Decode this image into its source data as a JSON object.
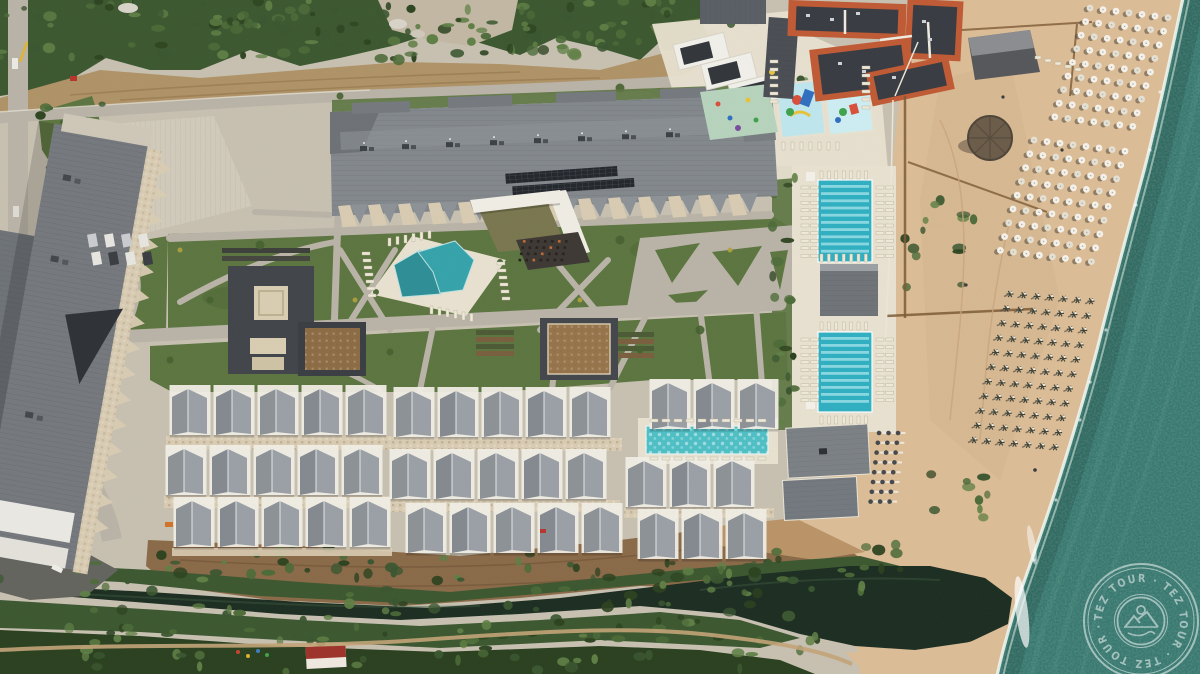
{
  "watermark": {
    "brand": "TEZ TOUR",
    "ring_text": "TEZ TOUR · TEZ TOUR · TEZ TOUR ·",
    "icon": "sun-over-mountains-logo"
  },
  "palette": {
    "ground": "#c8c1b2",
    "sand": "#dcbd97",
    "sandLight": "#e8cfa8",
    "sea": "#36786f",
    "seaDark": "#23524b",
    "surf": "#eef6f0",
    "lawn": "#5c7540",
    "lawnDark": "#47602f",
    "veg": "#3c5830",
    "vegDark": "#2a401f",
    "dirt": "#b09367",
    "dirtDark": "#8a6a48",
    "road": "#bab4a8",
    "roofGray": "#83888d",
    "roofLight": "#9aa0a5",
    "panelDark": "#23262b",
    "deck": "#e9e2d1",
    "terrace": "#d9ccb3",
    "terracotta": "#c05a34",
    "orangeRoofDark": "#383c42",
    "pool": "#2fb0c2",
    "poolLane": "#93dde5",
    "poolVilla": "#4fc0c6",
    "kidsPool": "#bfe7ee",
    "mint": "#b7d4bd",
    "river": "#1c2d21",
    "boardwalk": "#7d5a36",
    "white": "#f1eee6"
  },
  "decor": {
    "umbrella_grids": [
      {
        "x": 1090,
        "y": 8,
        "rows": 9,
        "cols": 7,
        "col_dx": 13,
        "col_dy": 1.6,
        "row_dx": -4.4,
        "row_dy": 13.6,
        "style": "open"
      },
      {
        "x": 1034,
        "y": 140,
        "rows": 9,
        "cols": 8,
        "col_dx": 13,
        "col_dy": 1.6,
        "row_dx": -4.2,
        "row_dy": 13.8,
        "style": "open"
      },
      {
        "x": 1010,
        "y": 294,
        "rows": 11,
        "cols": 7,
        "col_dx": 13.5,
        "col_dy": 1.2,
        "row_dx": -3.6,
        "row_dy": 14.6,
        "style": "closed"
      }
    ],
    "lap_pools": [
      {
        "x": 818,
        "y": 180,
        "w": 54,
        "h": 82,
        "lanes": 10
      },
      {
        "x": 818,
        "y": 332,
        "w": 54,
        "h": 80,
        "lanes": 10
      }
    ],
    "villa_rows": [
      {
        "segments": [
          {
            "x": 172,
            "y": 388,
            "units": 5
          },
          {
            "x": 396,
            "y": 390,
            "units": 5
          },
          {
            "x": 652,
            "y": 382,
            "units": 3
          }
        ]
      },
      {
        "segments": [
          {
            "x": 168,
            "y": 448,
            "units": 5
          },
          {
            "x": 392,
            "y": 452,
            "units": 5
          },
          {
            "x": 628,
            "y": 460,
            "units": 3
          }
        ]
      },
      {
        "segments": [
          {
            "x": 176,
            "y": 500,
            "units": 5
          },
          {
            "x": 408,
            "y": 506,
            "units": 5
          },
          {
            "x": 640,
            "y": 512,
            "units": 3
          }
        ]
      }
    ]
  }
}
